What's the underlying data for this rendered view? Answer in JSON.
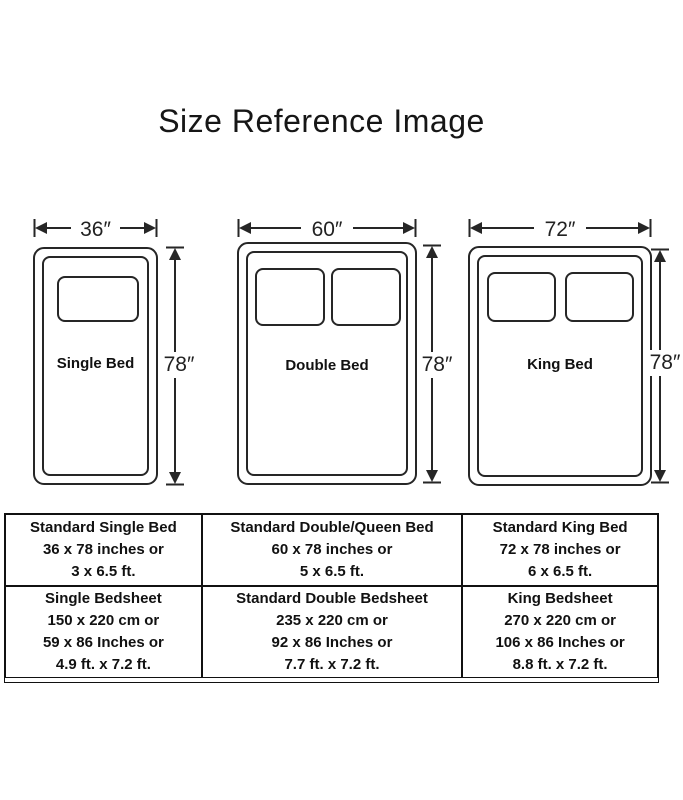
{
  "title": "Size Reference Image",
  "colors": {
    "ink": "#262626",
    "table_border": "#111111",
    "background": "#ffffff"
  },
  "beds": [
    {
      "name": "Single Bed",
      "width_label": "36″",
      "height_label": "78″",
      "pillows": 1
    },
    {
      "name": "Double Bed",
      "width_label": "60″",
      "height_label": "78″",
      "pillows": 2
    },
    {
      "name": "King Bed",
      "width_label": "72″",
      "height_label": "78″",
      "pillows": 2
    }
  ],
  "table": {
    "rows": [
      [
        [
          "Standard Single Bed",
          "36 x 78 inches or",
          "3 x 6.5 ft."
        ],
        [
          "Standard Double/Queen Bed",
          "60 x 78 inches or",
          "5 x 6.5 ft."
        ],
        [
          "Standard King Bed",
          "72 x 78 inches or",
          "6 x 6.5 ft."
        ]
      ],
      [
        [
          "Single Bedsheet",
          "150 x 220 cm or",
          "59 x 86 Inches or",
          "4.9 ft. x 7.2 ft."
        ],
        [
          "Standard Double Bedsheet",
          "235 x 220 cm or",
          "92 x 86 Inches or",
          "7.7 ft. x 7.2 ft."
        ],
        [
          "King Bedsheet",
          "270 x 220 cm or",
          "106 x 86 Inches or",
          "8.8 ft. x 7.2 ft."
        ]
      ]
    ]
  }
}
